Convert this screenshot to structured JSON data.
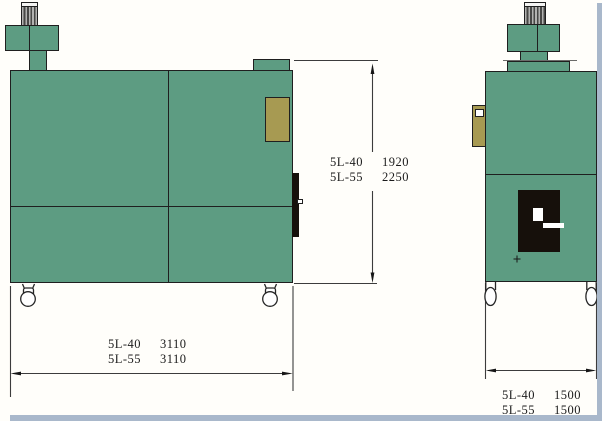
{
  "colors": {
    "machine_green": "#5d9c82",
    "outline": "#1f1f1f",
    "tan": "#a79a52",
    "panel_black": "#16100b",
    "frame_blue": "#a9b8cb",
    "background": "#fffefa",
    "dim_line": "#3c3c3c",
    "text": "#1b1b1b"
  },
  "dims": {
    "front_width": {
      "rows": [
        {
          "model": "5L-40",
          "value": "3110"
        },
        {
          "model": "5L-55",
          "value": "3110"
        }
      ]
    },
    "height": {
      "rows": [
        {
          "model": "5L-40",
          "value": "1920"
        },
        {
          "model": "5L-55",
          "value": "2250"
        }
      ]
    },
    "side_width": {
      "rows": [
        {
          "model": "5L-40",
          "value": "1500"
        },
        {
          "model": "5L-55",
          "value": "1500"
        }
      ]
    }
  }
}
